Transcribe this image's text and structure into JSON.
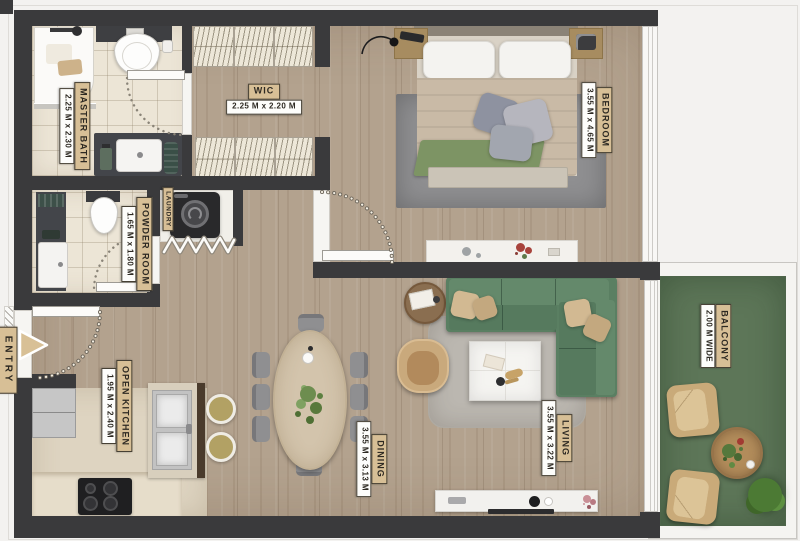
{
  "rooms": {
    "master_bath": {
      "label": "MASTER BATH",
      "dimensions": "2.25 M x 2.30 M"
    },
    "wic": {
      "label": "WIC",
      "dimensions": "2.25 M x 2.20 M"
    },
    "bedroom": {
      "label": "BEDROOM",
      "dimensions": "3.55 M x 4.65 M"
    },
    "powder_room": {
      "label": "POWDER ROOM",
      "dimensions": "1.65 M x 1.80 M"
    },
    "laundry": {
      "label": "LAUNDRY"
    },
    "entry": {
      "label": "ENTRY"
    },
    "open_kitchen": {
      "label": "OPEN KITCHEN",
      "dimensions": "1.95 M x 2.40 M"
    },
    "dining": {
      "label": "DINING",
      "dimensions": "3.55 M x 3.13 M"
    },
    "living": {
      "label": "LIVING",
      "dimensions": "3.55 M x 3.22 M"
    },
    "balcony": {
      "label": "BALCONY",
      "dimensions": "2.00 M WIDE"
    }
  },
  "colors": {
    "wall": "#3a3a3c",
    "wood": "#b3a28e",
    "tile": "#ece5d6",
    "kitchen-floor": "#ded4c1",
    "balcony-green": "#5d7658",
    "sofa-green": "#5a7f62",
    "plaque-tan": "#d7bf96",
    "plaque-white": "#fdfdfb",
    "rug-gray": "#8f8f91",
    "counter-dark": "#43454a",
    "accent-wood": "#b28c5b"
  }
}
